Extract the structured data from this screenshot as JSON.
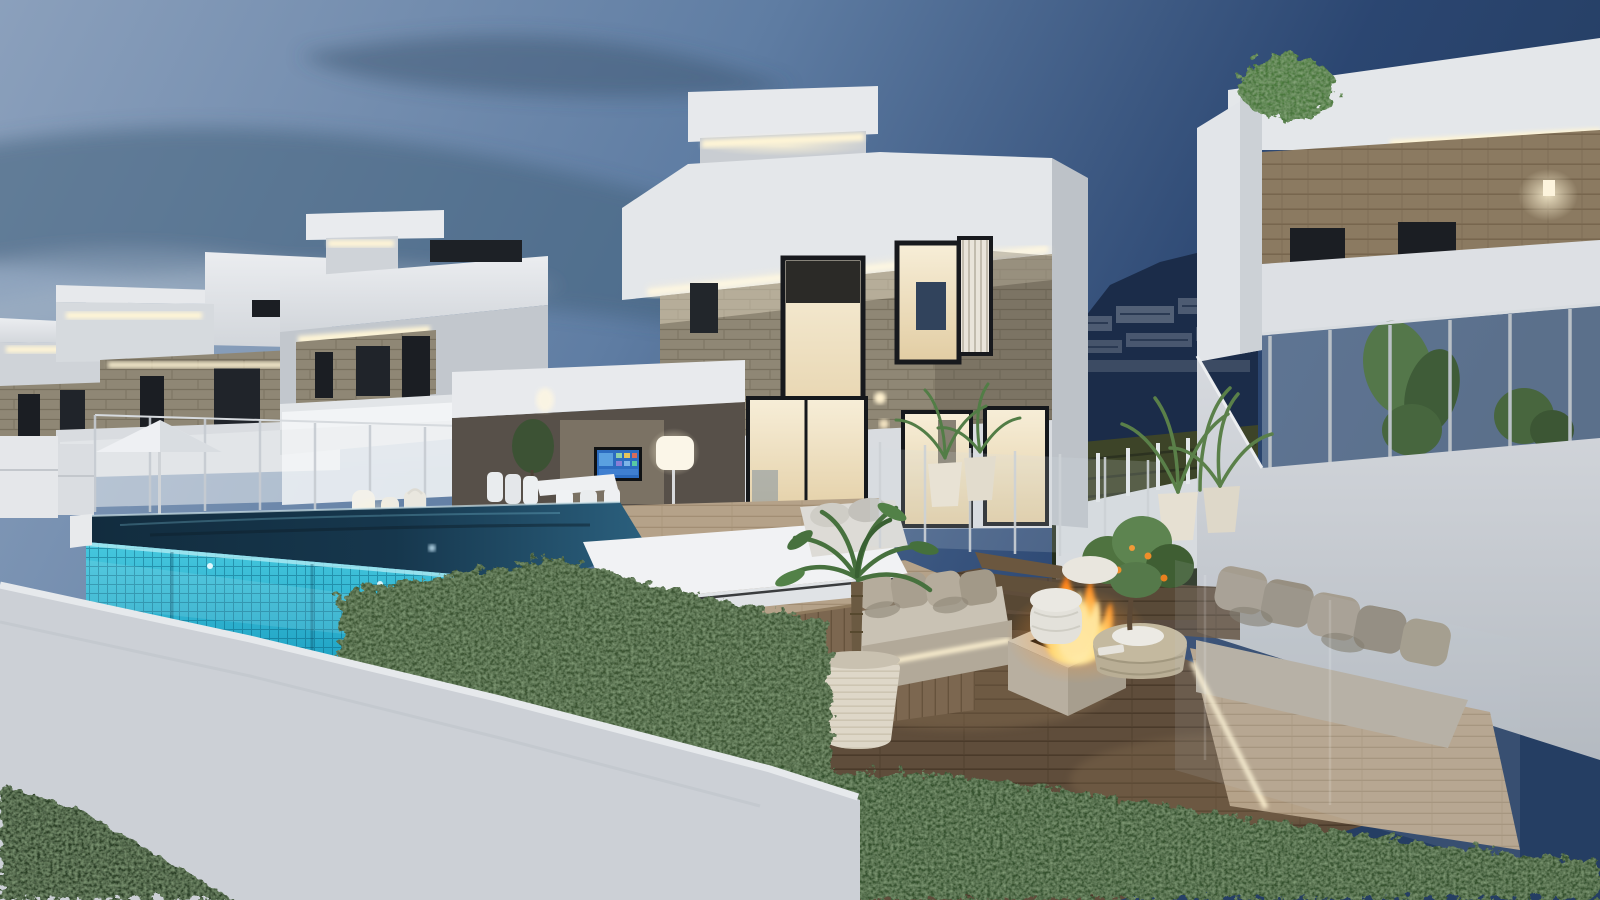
{
  "scene": {
    "kind": "architectural-3d-rendering",
    "time_of_day": "dusk",
    "subject": "Modern white luxury villas with infinity pool, sunken wooden lounge deck, fire pit and LED cove lighting",
    "objects": [
      "dusk sky with streaked clouds",
      "three receding white villas on the left with LED-lit roof slabs and stone-clad bands",
      "main two-storey villa with stone facade, glass stair window and warm lit interior",
      "wall-mounted TV on terrace",
      "white dining set",
      "glowing floor lamp",
      "white daybed by the pool",
      "infinity pool with turquoise glass tile wall",
      "glass pool fence",
      "white parasol",
      "paper lanterns",
      "sunken lounge with two beige sofas and LED underglow",
      "square travertine fire pit with flames",
      "round wicker coffee table",
      "white wicker stool",
      "small citrus tree with oranges",
      "potted palms in white ribbed planters",
      "right villa with wood-clad band, glass balcony and tropical plants",
      "mountain backdrop with apartment buildings",
      "boxwood hedges",
      "white boundary wall",
      "dark lawn",
      "flying bird"
    ],
    "palette": {
      "sky_left": "#8ba0bc",
      "sky_mid": "#5f7da3",
      "sky_right": "#2b4671",
      "cloud_dark": "#46617c",
      "cloud_light": "#9fb2c4",
      "mountain_navy": "#1b2c49",
      "villa_white": "#e4e7ea",
      "villa_shadow": "#c2c7cd",
      "stone_clad": "#8f8775",
      "wood_clad": "#8b7a61",
      "window_dark": "#1b1e23",
      "interior_warm": "#f2e6c8",
      "led_warm": "#fff5d6",
      "pool_water": "#16374d",
      "pool_tile_light": "#46c8de",
      "pool_tile_deep": "#0f81a6",
      "deck_wood": "#5f4d3b",
      "deck_tan": "#b5a289",
      "sofa_fabric": "#b2a999",
      "fire_orange": "#ff8a1e",
      "fire_yellow": "#ffd978",
      "hedge_green": "#3a5330",
      "grass_dark": "#2c3e25",
      "wall_white": "#ccd0d6",
      "tv_screen": "#2c6cc0"
    }
  }
}
